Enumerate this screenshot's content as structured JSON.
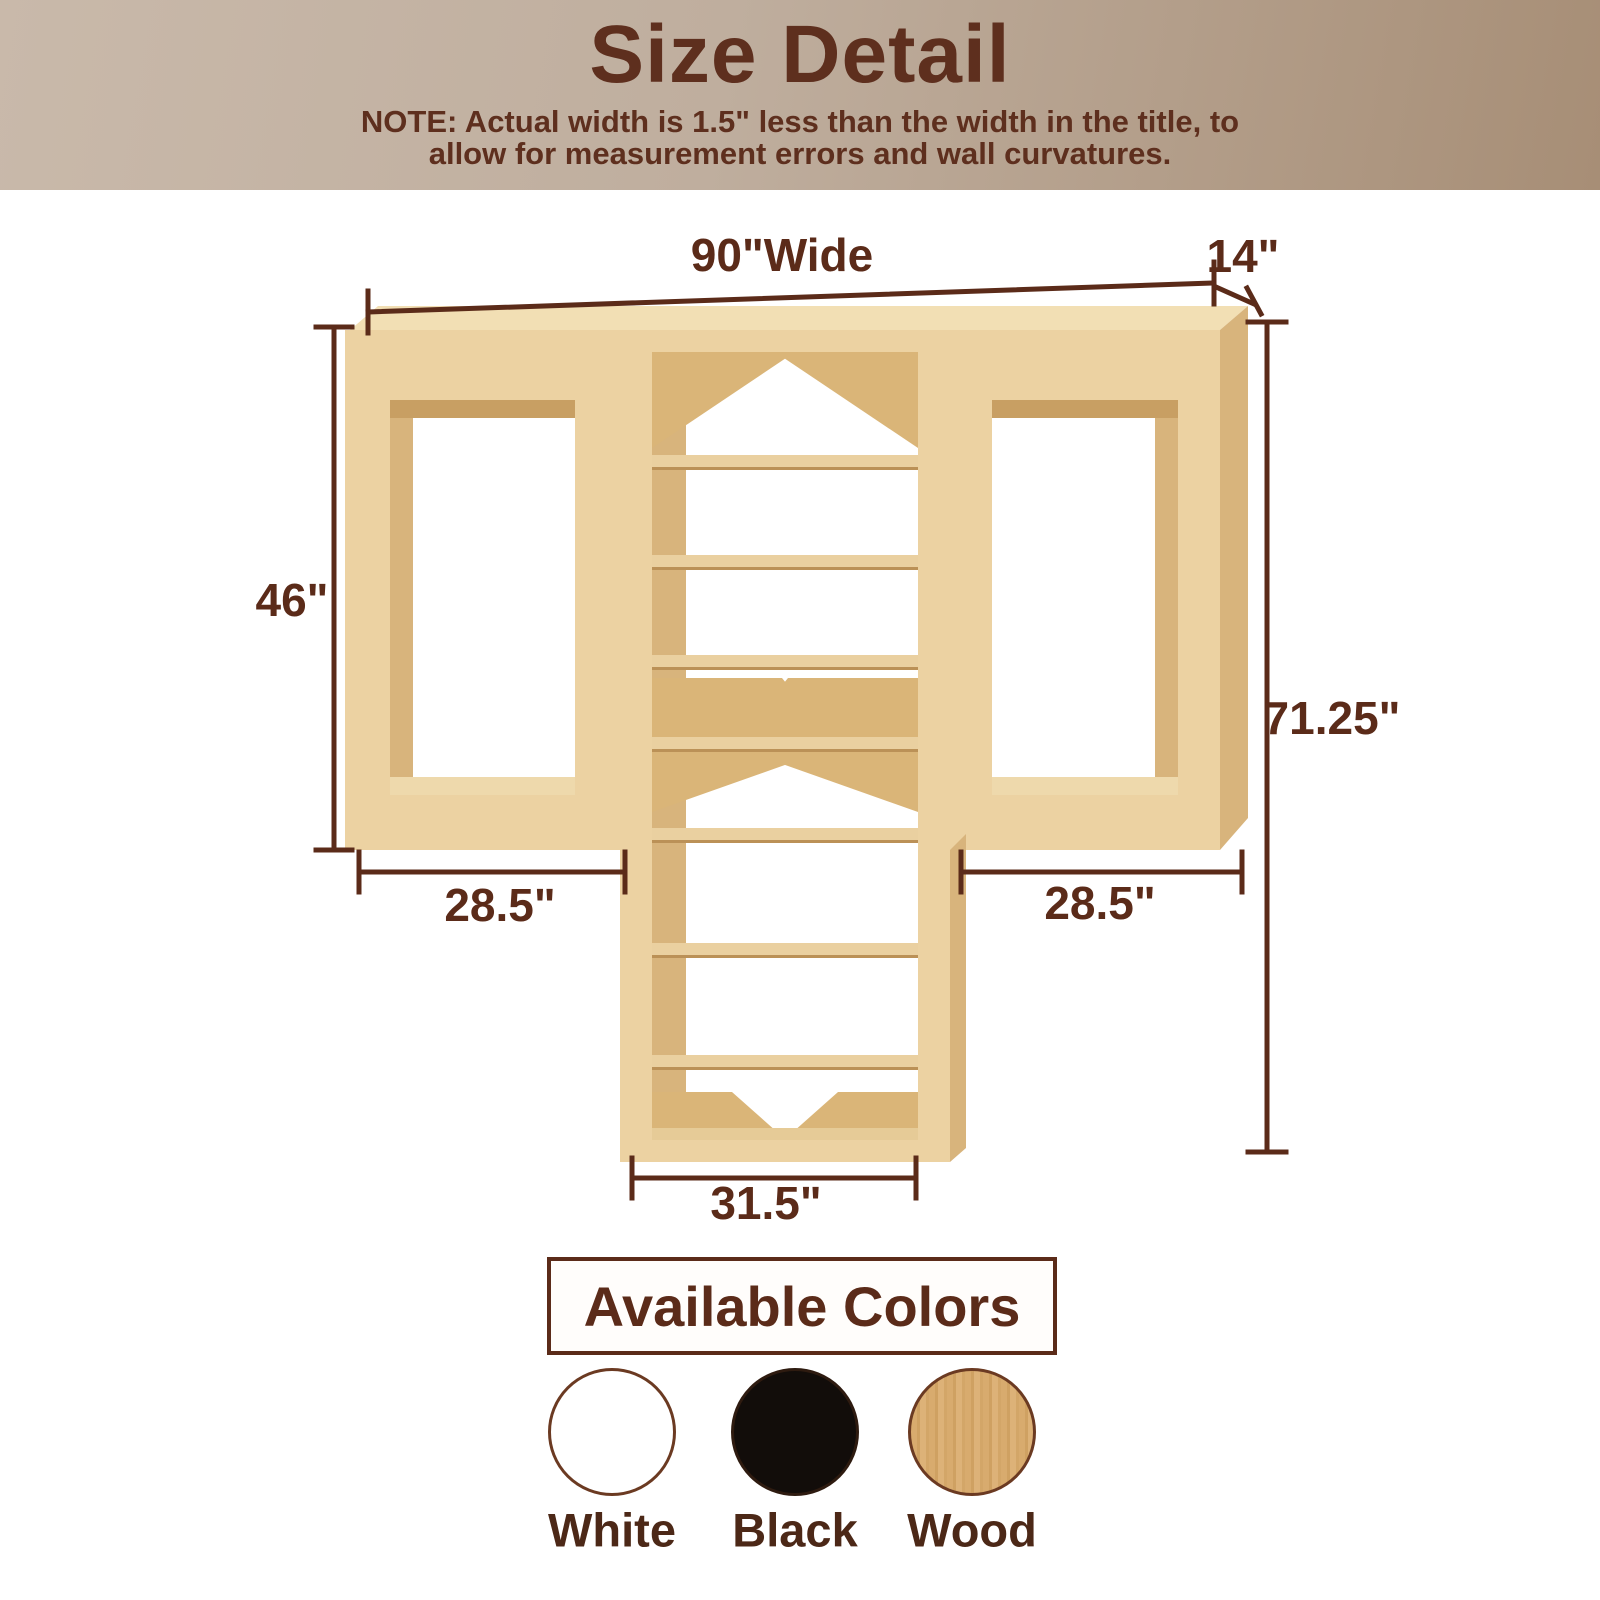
{
  "header": {
    "title": "Size Detail",
    "note_line1": "NOTE: Actual width is 1.5\" less than the width in the title, to",
    "note_line2": "allow for measurement errors and wall curvatures."
  },
  "diagram": {
    "product": "3-section closet organizer with two open hanging frames and a central shelf tower",
    "dimensions": {
      "width_total": "90\"Wide",
      "depth": "14\"",
      "left_height": "46\"",
      "total_height": "71.25\"",
      "left_width": "28.5\"",
      "right_width": "28.5\"",
      "tower_width": "31.5\""
    }
  },
  "colors_section": {
    "title": "Available Colors",
    "swatches": [
      {
        "label": "White",
        "color": "#ffffff"
      },
      {
        "label": "Black",
        "color": "#120d0a"
      },
      {
        "label": "Wood",
        "color": "#d8ab6e"
      }
    ]
  },
  "palette": {
    "header_background_left": "#c9b9aa",
    "header_background_right": "#a78e76",
    "header_text": "#5e2f1e",
    "dimension_color": "#5b2b19",
    "wood_face": "#ecd2a2",
    "wood_top": "#f2dfb4",
    "wood_side": "#d8b47c",
    "wood_inner": "#c89f63"
  }
}
